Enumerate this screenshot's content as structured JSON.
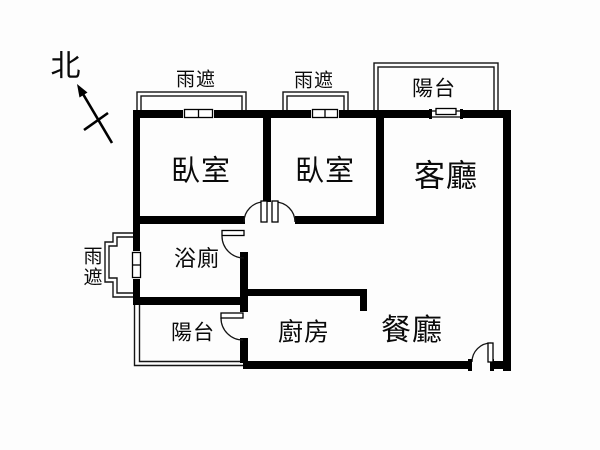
{
  "plan": {
    "type": "apartment-floor-plan",
    "compass": {
      "label": "北"
    },
    "rooms": {
      "bedroom1": {
        "label": "臥室"
      },
      "bedroom2": {
        "label": "臥室"
      },
      "living": {
        "label": "客廳"
      },
      "dining": {
        "label": "餐廳"
      },
      "kitchen": {
        "label": "廚房"
      },
      "bathroom": {
        "label": "浴廁"
      },
      "balcony_top": {
        "label": "陽台"
      },
      "balcony_bottom": {
        "label": "陽台"
      }
    },
    "canopies": {
      "top_left": {
        "label": "雨遮"
      },
      "top_mid": {
        "label": "雨遮"
      },
      "left_side": {
        "label": "雨遮"
      }
    },
    "colors": {
      "wall": "#000000",
      "thin_line": "#141414",
      "background": "#fdfdfd",
      "text": "#0a0a0a"
    }
  }
}
